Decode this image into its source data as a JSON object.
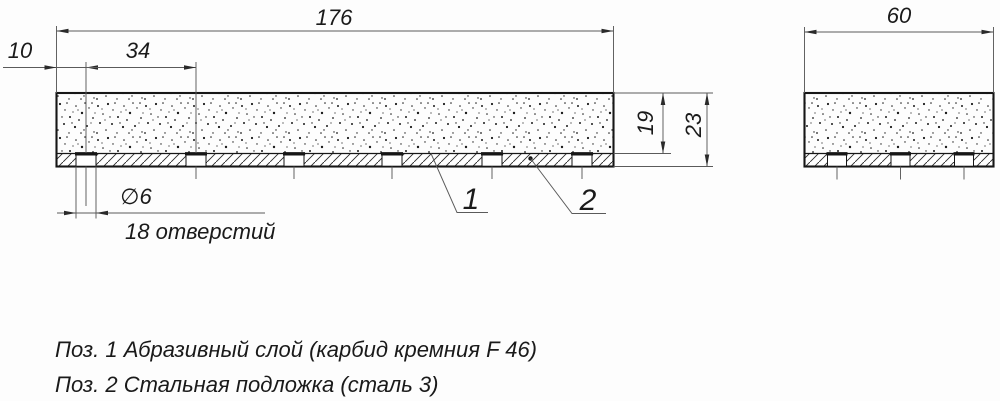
{
  "drawing": {
    "dims": {
      "length": "176",
      "edge_offset": "10",
      "hole_pitch": "34",
      "hole_diameter": "∅6",
      "holes_count_note": "18 отверстий",
      "abrasive_thickness": "19",
      "total_thickness": "23",
      "width": "60"
    },
    "positions": {
      "pos1": "1",
      "pos2": "2"
    },
    "notes": {
      "line1": "Поз. 1  Абразивный слой (карбид кремния F 46)",
      "line2": "Поз. 2  Стальная подложка (сталь 3)"
    }
  }
}
